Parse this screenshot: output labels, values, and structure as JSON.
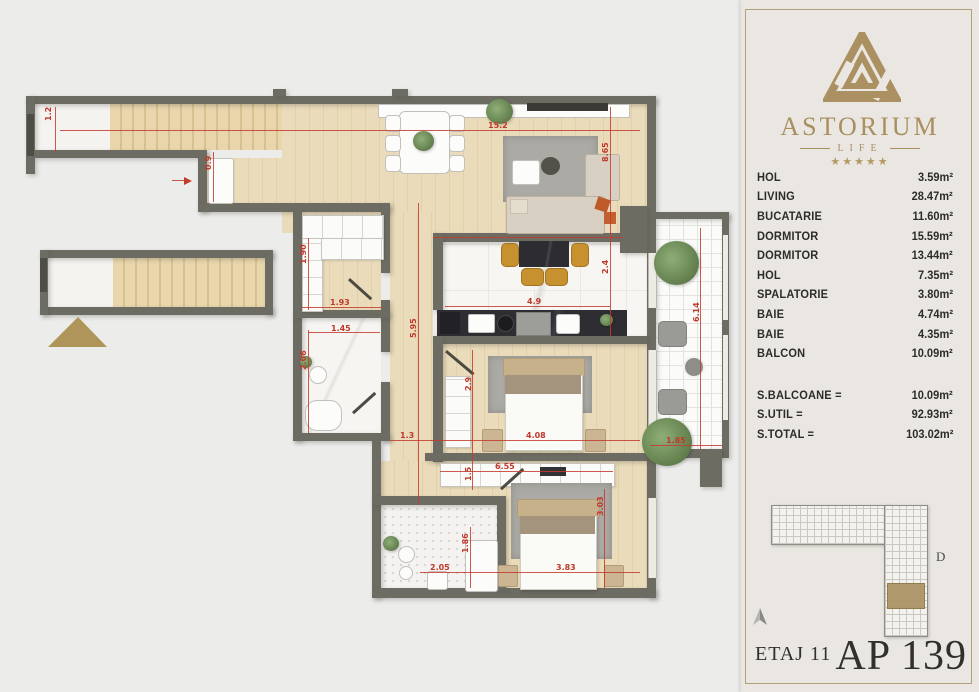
{
  "sidebar": {
    "brand": {
      "name": "ASTORIUM",
      "subtitle": "LIFE",
      "stars": "★★★★★"
    },
    "rooms": [
      {
        "label": "HOL",
        "area": "3.59m²"
      },
      {
        "label": "LIVING",
        "area": "28.47m²"
      },
      {
        "label": "BUCATARIE",
        "area": "11.60m²"
      },
      {
        "label": "DORMITOR",
        "area": "15.59m²"
      },
      {
        "label": "DORMITOR",
        "area": "13.44m²"
      },
      {
        "label": "HOL",
        "area": "7.35m²"
      },
      {
        "label": "SPALATORIE",
        "area": "3.80m²"
      },
      {
        "label": "BAIE",
        "area": "4.74m²"
      },
      {
        "label": "BAIE",
        "area": "4.35m²"
      },
      {
        "label": "BALCON",
        "area": "10.09m²"
      }
    ],
    "totals": [
      {
        "label": "S.BALCOANE =",
        "area": "10.09m²"
      },
      {
        "label": "S.UTIL =",
        "area": "92.93m²"
      },
      {
        "label": "S.TOTAL =",
        "area": "103.02m²"
      }
    ],
    "keyplan": {
      "section_label": "D"
    },
    "footer": {
      "floor": "ETAJ 11",
      "apartment": "AP 139"
    }
  },
  "plan": {
    "dimensions": [
      {
        "t": "1.2",
        "x": 44,
        "y": 121,
        "rot": 1
      },
      {
        "t": "15.2",
        "x": 488,
        "y": 121,
        "rot": 0
      },
      {
        "t": "0.9",
        "x": 204,
        "y": 170,
        "rot": 1
      },
      {
        "t": "8.65",
        "x": 601,
        "y": 162,
        "rot": 1
      },
      {
        "t": "2.4",
        "x": 601,
        "y": 274,
        "rot": 1
      },
      {
        "t": "4.9",
        "x": 527,
        "y": 297,
        "rot": 0
      },
      {
        "t": "5.95",
        "x": 409,
        "y": 338,
        "rot": 1
      },
      {
        "t": "1.90",
        "x": 299,
        "y": 264,
        "rot": 1
      },
      {
        "t": "1.93",
        "x": 330,
        "y": 298,
        "rot": 0
      },
      {
        "t": "1.45",
        "x": 331,
        "y": 324,
        "rot": 0
      },
      {
        "t": "2.06",
        "x": 299,
        "y": 370,
        "rot": 1
      },
      {
        "t": "1.3",
        "x": 400,
        "y": 431,
        "rot": 0
      },
      {
        "t": "2.9",
        "x": 464,
        "y": 391,
        "rot": 1
      },
      {
        "t": "4.08",
        "x": 526,
        "y": 431,
        "rot": 0
      },
      {
        "t": "6.55",
        "x": 495,
        "y": 462,
        "rot": 0
      },
      {
        "t": "1.5",
        "x": 464,
        "y": 481,
        "rot": 1
      },
      {
        "t": "1.85",
        "x": 666,
        "y": 436,
        "rot": 0
      },
      {
        "t": "1.86",
        "x": 461,
        "y": 553,
        "rot": 1
      },
      {
        "t": "2.05",
        "x": 430,
        "y": 563,
        "rot": 0
      },
      {
        "t": "3.83",
        "x": 556,
        "y": 563,
        "rot": 0
      },
      {
        "t": "3.03",
        "x": 596,
        "y": 516,
        "rot": 1
      },
      {
        "t": "6.14",
        "x": 692,
        "y": 322,
        "rot": 1
      }
    ]
  },
  "colors": {
    "accent_gold": "#ab9162",
    "wall": "#6d6c62",
    "dim_red": "#c0392b",
    "panel_bg": "#eae7e2"
  }
}
